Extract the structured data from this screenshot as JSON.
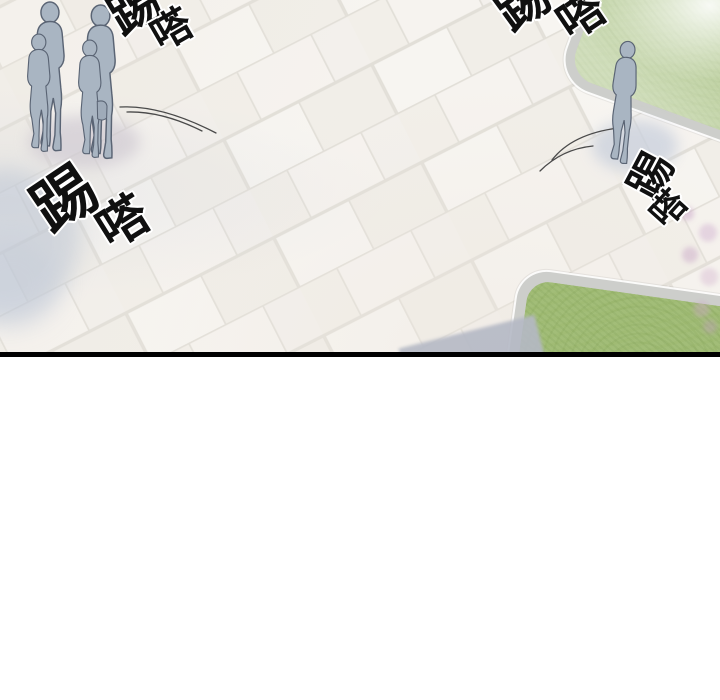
{
  "scene": {
    "sfx": {
      "top_left": {
        "char1": "踢",
        "char2": "嗒"
      },
      "top_right": {
        "char1": "踢",
        "char2": "嗒"
      },
      "mid_left": {
        "char1": "踢",
        "char2": "嗒"
      },
      "mid_right": {
        "char1": "踢",
        "char2": "嗒"
      }
    },
    "colors": {
      "background": "#ffffff",
      "panel_border": "#000000",
      "pavement": "#f4f2ee",
      "grout": "#e2dfd8",
      "grass": "#a2bd78",
      "curb": "#cdcecb",
      "figure_fill": "#a9b5c2",
      "figure_outline": "#5a6474",
      "sfx": "#101010"
    }
  }
}
